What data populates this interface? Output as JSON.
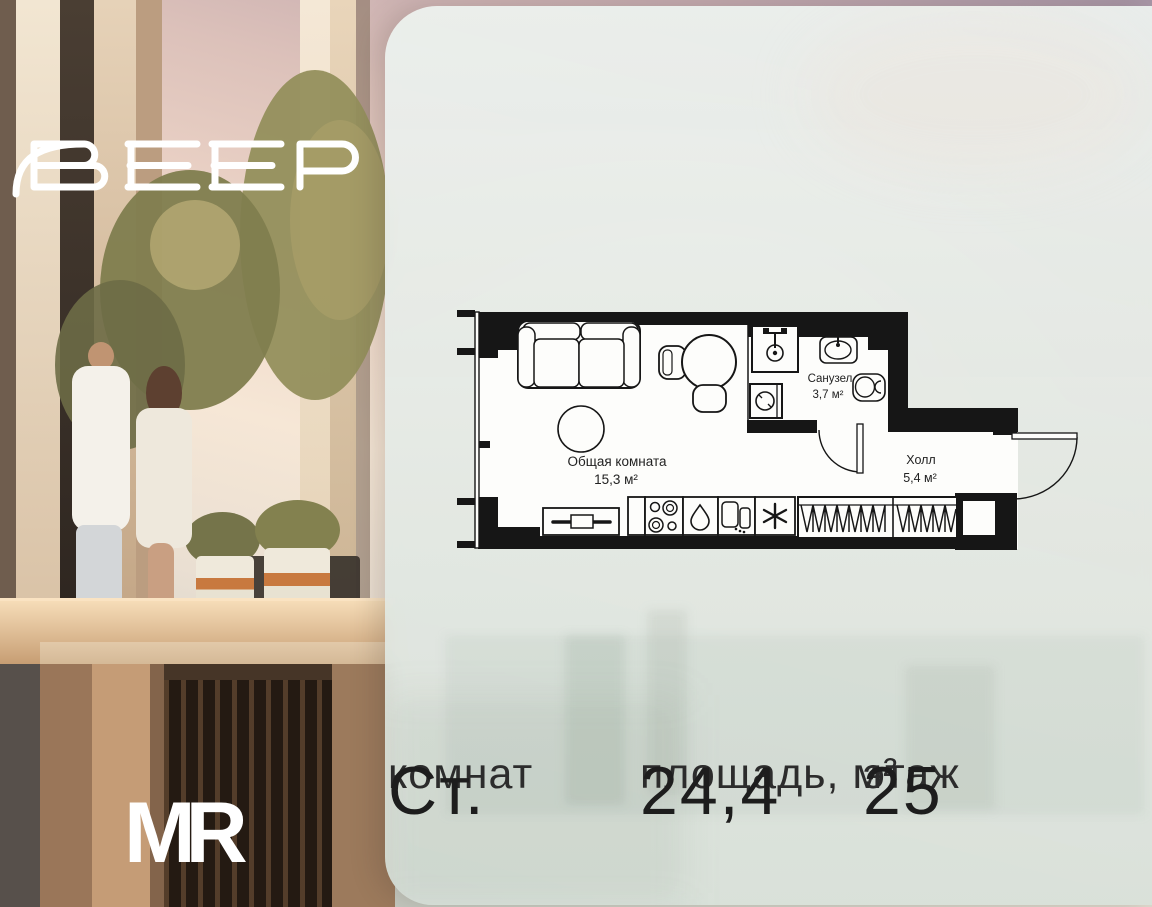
{
  "brand": {
    "logo_text": "ВЕЕР",
    "developer_logo": "MR"
  },
  "floor_plan": {
    "rooms": [
      {
        "name": "Общая комната",
        "area": "15,3 м²"
      },
      {
        "name": "Санузел",
        "area": "3,7 м²"
      },
      {
        "name": "Холл",
        "area": "5,4 м²"
      }
    ]
  },
  "summary": {
    "columns": [
      {
        "label": "комнат",
        "value": "Ст."
      },
      {
        "label": "площадь, м²",
        "value": "24,4"
      },
      {
        "label": "этаж",
        "value": "25"
      }
    ]
  },
  "colors": {
    "plan_line": "#161616",
    "room_fill": "#fdfdfb",
    "panel_tint": "#e4eae5",
    "accent_copper": "#c8793f"
  }
}
